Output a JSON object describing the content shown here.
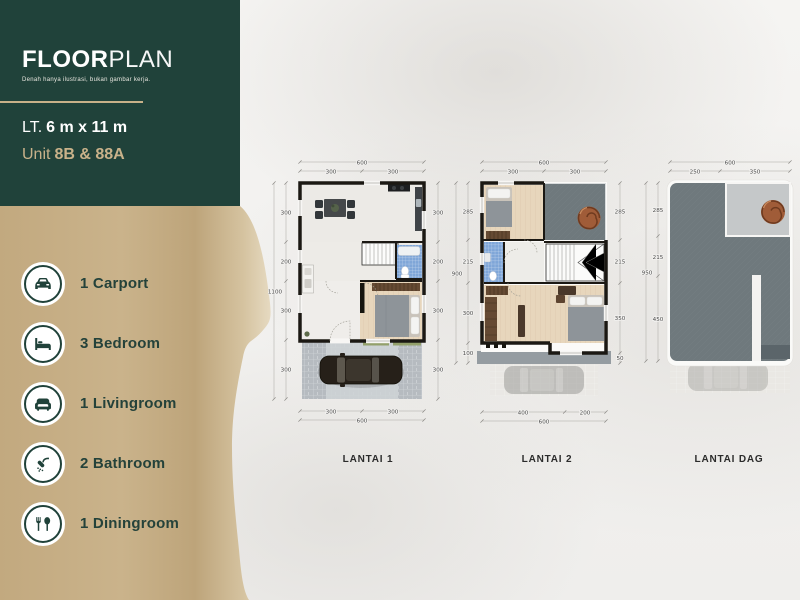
{
  "colors": {
    "brand_green": "#20423a",
    "brand_tan": "#c8b189",
    "bathroom_blue": "#7fa6d8",
    "roof_gray": "#6f797d",
    "wood_floor": "#e7d6bc",
    "grass_green": "#93a06b"
  },
  "header": {
    "title_bold": "FLOOR",
    "title_light": "PLAN",
    "subtitle": "Denah hanya ilustrasi, bukan gambar kerja.",
    "lot_prefix": "LT.",
    "lot_size": "6 m x 11 m",
    "unit_prefix": "Unit",
    "unit_value": "8B & 88A"
  },
  "features": [
    {
      "icon": "car-icon",
      "label": "1 Carport"
    },
    {
      "icon": "bed-icon",
      "label": "3 Bedroom"
    },
    {
      "icon": "sofa-icon",
      "label": "1 Livingroom"
    },
    {
      "icon": "shower-icon",
      "label": "2 Bathroom"
    },
    {
      "icon": "cutlery-icon",
      "label": "1 Diningroom"
    }
  ],
  "plans": [
    {
      "label": "LANTAI 1",
      "top_total": "600",
      "top_splits": [
        "300",
        "300"
      ],
      "left_total": "1100",
      "left_dims": [
        "300",
        "200",
        "300",
        "300"
      ],
      "right_dims": [
        "300",
        "200",
        "300",
        "300"
      ],
      "bottom_splits": [
        "300",
        "300"
      ],
      "bottom_total": "600"
    },
    {
      "label": "LANTAI 2",
      "top_total": "600",
      "top_splits": [
        "300",
        "300"
      ],
      "left_total": "900",
      "left_dims": [
        "285",
        "215",
        "300",
        "100"
      ],
      "right_dims": [
        "285",
        "215",
        "350",
        "50"
      ],
      "bottom_splits": [
        "400",
        "200"
      ],
      "bottom_total": "600"
    },
    {
      "label": "LANTAI DAG",
      "top_total": "600",
      "top_splits": [
        "250",
        "350"
      ],
      "left_total": "950",
      "left_dims": [
        "285",
        "215",
        "450"
      ]
    }
  ]
}
